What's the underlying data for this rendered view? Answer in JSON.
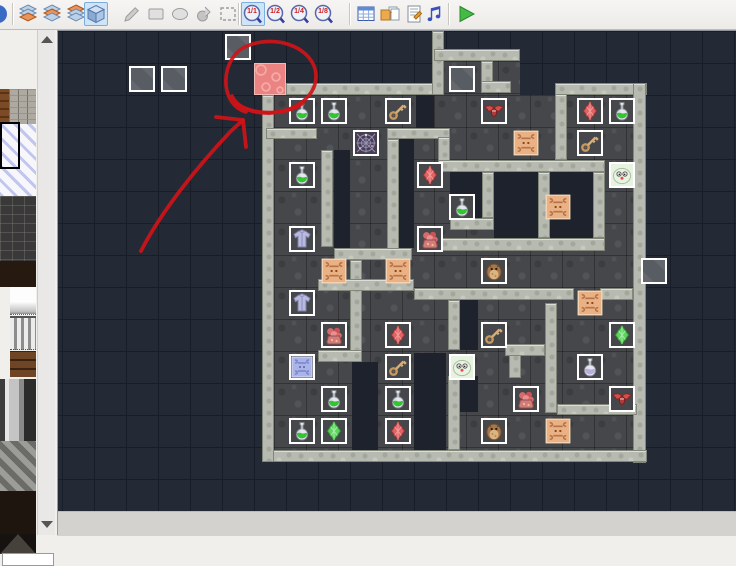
{
  "app": {
    "title": "Tile map editor with dungeon map and red error annotation"
  },
  "colors": {
    "toolbar_bg": "#f2f1ef",
    "canvas_bg": "#242936",
    "grid_line": "#191d27",
    "floor": "#46474b",
    "wall": "#b6bab0",
    "void": "#1d222d",
    "pink_tile": "#ea8381",
    "event_border": "#ffffff",
    "annotation": "#cf1418",
    "selected_tool_bg": "#cfe4f7",
    "rug_orange": "#e8b083",
    "rug_blue": "#aab4e8"
  },
  "toolbar": {
    "items": [
      {
        "name": "sphere-icon",
        "icon": "sphere",
        "x": -13,
        "state": "normal"
      },
      {
        "name": "layer1-button",
        "icon": "layers0",
        "x": 17,
        "state": "normal"
      },
      {
        "name": "layer2-button",
        "icon": "layers1",
        "x": 41,
        "state": "normal"
      },
      {
        "name": "layer3-button",
        "icon": "layers2",
        "x": 65,
        "state": "normal"
      },
      {
        "name": "all-layers-button",
        "icon": "cube",
        "x": 84,
        "state": "selected"
      },
      {
        "name": "pencil-tool-button",
        "icon": "pencil",
        "x": 121,
        "state": "disabled"
      },
      {
        "name": "rectangle-tool-button",
        "icon": "rect",
        "x": 145,
        "state": "disabled"
      },
      {
        "name": "ellipse-tool-button",
        "icon": "ellipse",
        "x": 169,
        "state": "disabled"
      },
      {
        "name": "fill-tool-button",
        "icon": "fill",
        "x": 193,
        "state": "disabled"
      },
      {
        "name": "select-tool-button",
        "icon": "select",
        "x": 217,
        "state": "disabled"
      },
      {
        "name": "zoom-1-1-button",
        "icon": "zoom",
        "x": 241,
        "state": "selected",
        "label": "1/1"
      },
      {
        "name": "zoom-1-2-button",
        "icon": "zoom",
        "x": 265,
        "state": "normal",
        "label": "1/2"
      },
      {
        "name": "zoom-1-4-button",
        "icon": "zoom",
        "x": 289,
        "state": "normal",
        "label": "1/4"
      },
      {
        "name": "zoom-1-8-button",
        "icon": "zoom",
        "x": 313,
        "state": "normal",
        "label": "1/8"
      },
      {
        "name": "database-button",
        "icon": "db",
        "x": 355,
        "state": "normal"
      },
      {
        "name": "resources-button",
        "icon": "folder",
        "x": 379,
        "state": "normal"
      },
      {
        "name": "script-button",
        "icon": "script",
        "x": 403,
        "state": "normal"
      },
      {
        "name": "sound-button",
        "icon": "music",
        "x": 424,
        "state": "normal"
      },
      {
        "name": "playtest-button",
        "icon": "play",
        "x": 455,
        "state": "normal"
      }
    ],
    "separators": [
      12,
      238,
      349,
      448
    ]
  },
  "sidebar": {
    "tiles": [
      {
        "name": "palette-tile-wood",
        "tex": "wood",
        "x": 0,
        "y": 60,
        "w": 9,
        "h": 35
      },
      {
        "name": "palette-tile-bricks",
        "tex": "brick",
        "x": 9,
        "y": 60,
        "w": 27,
        "h": 35
      },
      {
        "name": "palette-tile-white-diagonal",
        "tex": "whitediag",
        "x": 0,
        "y": 95,
        "w": 36,
        "h": 72
      },
      {
        "name": "palette-tile-darkstone",
        "tex": "darkstone",
        "x": 0,
        "y": 167,
        "w": 36,
        "h": 65
      },
      {
        "name": "palette-tile-darkbrown",
        "tex": "darkbrown",
        "x": 0,
        "y": 232,
        "w": 36,
        "h": 26
      },
      {
        "name": "palette-tile-white",
        "tex": "whitegrad",
        "x": 10,
        "y": 258,
        "w": 26,
        "h": 27
      },
      {
        "name": "palette-tile-bars",
        "tex": "bars",
        "x": 10,
        "y": 287,
        "w": 26,
        "h": 31
      },
      {
        "name": "palette-tile-shelf",
        "tex": "shelf",
        "x": 10,
        "y": 322,
        "w": 26,
        "h": 26
      },
      {
        "name": "palette-tile-pillar",
        "tex": "pillar",
        "x": 0,
        "y": 350,
        "w": 36,
        "h": 62
      },
      {
        "name": "palette-tile-hatch",
        "tex": "hatch",
        "x": 0,
        "y": 412,
        "w": 36,
        "h": 50
      },
      {
        "name": "palette-tile-darkfloor",
        "tex": "darkfloor2",
        "x": 0,
        "y": 462,
        "w": 36,
        "h": 43
      },
      {
        "name": "palette-tile-pyramid",
        "tex": "pyramid",
        "x": 0,
        "y": 505,
        "w": 36,
        "h": 20
      },
      {
        "name": "palette-next-row",
        "tex": "white-box",
        "x": 2,
        "y": 524,
        "w": 50,
        "h": 11
      }
    ],
    "selection": {
      "x": 0,
      "y": 93,
      "w": 16,
      "h": 43
    }
  },
  "map": {
    "grid": {
      "cell": 32,
      "origin_x": 5,
      "origin_y": 0,
      "cols": 21,
      "rows": 15
    },
    "floors": [
      [
        217,
        64,
        366,
        355
      ],
      [
        377,
        30,
        86,
        34
      ]
    ],
    "voids": [
      [
        359,
        64,
        18,
        33
      ],
      [
        342,
        108,
        15,
        109
      ],
      [
        277,
        119,
        16,
        98
      ],
      [
        393,
        141,
        32,
        46
      ],
      [
        437,
        141,
        44,
        66
      ],
      [
        493,
        141,
        43,
        66
      ],
      [
        403,
        269,
        18,
        50
      ],
      [
        357,
        322,
        32,
        97
      ],
      [
        295,
        331,
        26,
        88
      ],
      [
        403,
        345,
        18,
        36
      ]
    ],
    "walls": [
      [
        229,
        52,
        148,
        12
      ],
      [
        375,
        0,
        12,
        64
      ],
      [
        377,
        18,
        86,
        12
      ],
      [
        424,
        30,
        12,
        30
      ],
      [
        424,
        50,
        30,
        12
      ],
      [
        498,
        52,
        92,
        12
      ],
      [
        576,
        52,
        13,
        380
      ],
      [
        205,
        419,
        385,
        12
      ],
      [
        205,
        64,
        12,
        367
      ],
      [
        209,
        97,
        51,
        11
      ],
      [
        498,
        63,
        12,
        66
      ],
      [
        330,
        97,
        63,
        11
      ],
      [
        330,
        108,
        12,
        120
      ],
      [
        381,
        106,
        12,
        27
      ],
      [
        381,
        129,
        167,
        12
      ],
      [
        425,
        141,
        12,
        46
      ],
      [
        393,
        187,
        44,
        12
      ],
      [
        481,
        141,
        12,
        66
      ],
      [
        536,
        141,
        12,
        66
      ],
      [
        381,
        207,
        167,
        13
      ],
      [
        264,
        119,
        12,
        97
      ],
      [
        277,
        217,
        78,
        12
      ],
      [
        293,
        229,
        12,
        91
      ],
      [
        261,
        248,
        96,
        12
      ],
      [
        261,
        319,
        44,
        12
      ],
      [
        357,
        257,
        160,
        12
      ],
      [
        543,
        257,
        33,
        12
      ],
      [
        488,
        272,
        12,
        110
      ],
      [
        500,
        373,
        80,
        11
      ],
      [
        391,
        269,
        12,
        50
      ],
      [
        391,
        345,
        12,
        74
      ],
      [
        452,
        321,
        12,
        26
      ],
      [
        448,
        313,
        40,
        12
      ]
    ],
    "pink_tile": {
      "x": 197,
      "y": 32,
      "w": 32,
      "h": 32
    },
    "rugs_orange": [
      [
        14,
        3
      ],
      [
        15,
        5
      ],
      [
        8,
        7
      ],
      [
        10,
        7
      ],
      [
        16,
        8
      ],
      [
        15,
        12
      ]
    ],
    "events": [
      {
        "t": "gray",
        "c": 5,
        "r": 0
      },
      {
        "t": "gray",
        "c": 2,
        "r": 1
      },
      {
        "t": "gray",
        "c": 3,
        "r": 1
      },
      {
        "t": "gray",
        "c": 12,
        "r": 1
      },
      {
        "t": "gray",
        "c": 18,
        "r": 7
      },
      {
        "t": "potion-green",
        "c": 7,
        "r": 2
      },
      {
        "t": "potion-green",
        "c": 8,
        "r": 2
      },
      {
        "t": "potion-green",
        "c": 17,
        "r": 2
      },
      {
        "t": "potion-green",
        "c": 7,
        "r": 4
      },
      {
        "t": "potion-green",
        "c": 12,
        "r": 5
      },
      {
        "t": "potion-green",
        "c": 8,
        "r": 11
      },
      {
        "t": "potion-green",
        "c": 10,
        "r": 11
      },
      {
        "t": "potion-green",
        "c": 7,
        "r": 12
      },
      {
        "t": "potion-purple",
        "c": 16,
        "r": 10
      },
      {
        "t": "key",
        "c": 10,
        "r": 2
      },
      {
        "t": "key",
        "c": 16,
        "r": 3
      },
      {
        "t": "key",
        "c": 13,
        "r": 9
      },
      {
        "t": "key",
        "c": 10,
        "r": 10
      },
      {
        "t": "bat",
        "c": 13,
        "r": 2
      },
      {
        "t": "bat",
        "c": 17,
        "r": 11
      },
      {
        "t": "crystal-red",
        "c": 16,
        "r": 2
      },
      {
        "t": "crystal-red",
        "c": 11,
        "r": 4
      },
      {
        "t": "crystal-red",
        "c": 10,
        "r": 9
      },
      {
        "t": "crystal-red",
        "c": 10,
        "r": 12
      },
      {
        "t": "crystal-green",
        "c": 17,
        "r": 9
      },
      {
        "t": "crystal-green",
        "c": 8,
        "r": 12
      },
      {
        "t": "web",
        "c": 9,
        "r": 3
      },
      {
        "t": "slime",
        "c": 17,
        "r": 4
      },
      {
        "t": "slime",
        "c": 12,
        "r": 10
      },
      {
        "t": "armor",
        "c": 7,
        "r": 6
      },
      {
        "t": "armor",
        "c": 7,
        "r": 8
      },
      {
        "t": "bag-red",
        "c": 11,
        "r": 6
      },
      {
        "t": "bag-red",
        "c": 8,
        "r": 9
      },
      {
        "t": "bag-red",
        "c": 14,
        "r": 11
      },
      {
        "t": "owl",
        "c": 13,
        "r": 7
      },
      {
        "t": "owl",
        "c": 13,
        "r": 12
      },
      {
        "t": "rug-blue",
        "c": 7,
        "r": 10
      }
    ]
  },
  "annotation": {
    "color": "#cf1418",
    "circle_paths": [
      "M246,112 C218,104 220,57 247,46 C276,34 309,47 315,69 C321,92 299,111 271,113 C252,114 237,107 232,96",
      "M237,104 C254,115 285,116 303,103"
    ],
    "arrow_shaft": "M141,251 C161,212 196,168 231,131 L243,120",
    "arrow_head": "M243,120 L216,117 M243,120 L246,147"
  }
}
